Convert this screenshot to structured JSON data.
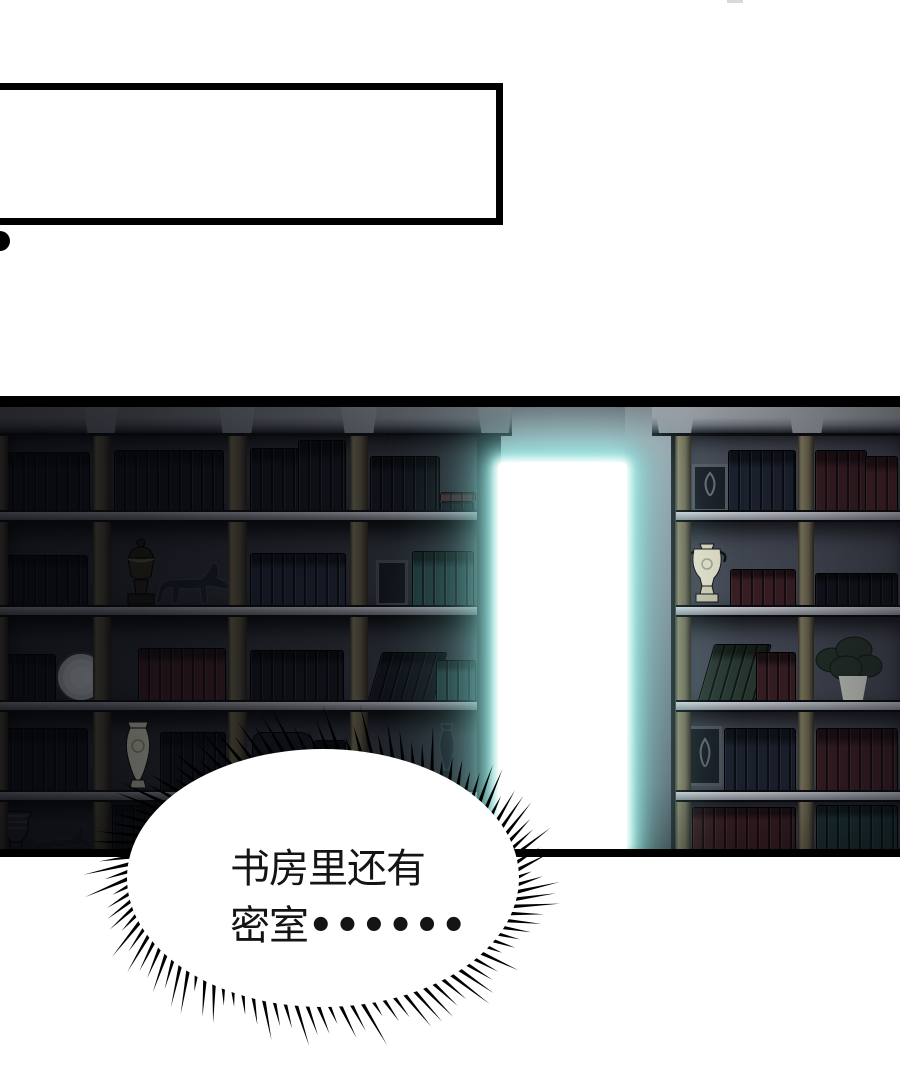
{
  "panel_top": {
    "type": "empty-speech-box",
    "text": ""
  },
  "speech_bubble": {
    "line1": "书房里还有",
    "line2": "密室",
    "ellipsis_dots": "••••••"
  },
  "palette": {
    "glow": "#8ce6df",
    "door_white": "#ffffff",
    "wall_light": "#9aa0a9",
    "panel_dark": "#23262d",
    "book_dark": "#12151c",
    "book_maroon": "#3c2026",
    "book_green": "#2a3a33",
    "book_teal": "#20393b",
    "cream": "#e6e2cc",
    "ink": "#000000"
  }
}
